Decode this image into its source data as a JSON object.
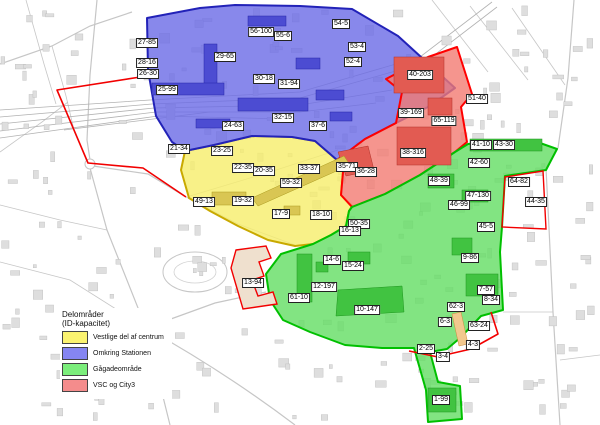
{
  "legend": {
    "title_line1": "Delområder",
    "title_line2": "(ID-kapacitet)",
    "items": [
      {
        "zone": "vestlige",
        "label": "Vestlige del af centrum",
        "color": "#fbf370"
      },
      {
        "zone": "station",
        "label": "Omkring Stationen",
        "color": "#8585f2"
      },
      {
        "zone": "gagade",
        "label": "Gågadeområde",
        "color": "#7bee7b"
      },
      {
        "zone": "vsc",
        "label": "VSC og City3",
        "color": "#f48c8c"
      }
    ]
  },
  "zones": {
    "station": {
      "name": "Omkring Stationen",
      "fill": "#6a6ae6",
      "border": "#2222b8"
    },
    "vestlige": {
      "name": "Vestlige del af centrum",
      "fill": "#f6ee6a",
      "border": "#c9a900"
    },
    "gagade": {
      "name": "Gågadeområde",
      "fill": "#63dd63",
      "border": "#00c000"
    },
    "vsc": {
      "name": "VSC og City3",
      "fill": "#f27b72",
      "border": "#ff0000"
    }
  },
  "map": {
    "labels": [
      {
        "id": "27-85",
        "zone": "station",
        "x": 147,
        "y": 43
      },
      {
        "id": "28-16",
        "zone": "station",
        "x": 147,
        "y": 63
      },
      {
        "id": "26-30",
        "zone": "station",
        "x": 148,
        "y": 74
      },
      {
        "id": "25-99",
        "zone": "station",
        "x": 167,
        "y": 90
      },
      {
        "id": "56-100",
        "zone": "station",
        "x": 261,
        "y": 32
      },
      {
        "id": "55-6",
        "zone": "station",
        "x": 283,
        "y": 36
      },
      {
        "id": "29-65",
        "zone": "station",
        "x": 225,
        "y": 57
      },
      {
        "id": "54-5",
        "zone": "station",
        "x": 341,
        "y": 24
      },
      {
        "id": "53-4",
        "zone": "station",
        "x": 357,
        "y": 47
      },
      {
        "id": "52-4",
        "zone": "station",
        "x": 353,
        "y": 62
      },
      {
        "id": "30-18",
        "zone": "station",
        "x": 264,
        "y": 79
      },
      {
        "id": "31-94",
        "zone": "station",
        "x": 289,
        "y": 84
      },
      {
        "id": "32-15",
        "zone": "station",
        "x": 283,
        "y": 118
      },
      {
        "id": "37-6",
        "zone": "station",
        "x": 318,
        "y": 126
      },
      {
        "id": "24-63",
        "zone": "station",
        "x": 233,
        "y": 126
      },
      {
        "id": "21-34",
        "zone": "station",
        "x": 179,
        "y": 149
      },
      {
        "id": "23-25",
        "zone": "vestlige",
        "x": 222,
        "y": 151
      },
      {
        "id": "22-35",
        "zone": "vestlige",
        "x": 243,
        "y": 168
      },
      {
        "id": "20-35",
        "zone": "vestlige",
        "x": 264,
        "y": 171
      },
      {
        "id": "33-37",
        "zone": "vestlige",
        "x": 309,
        "y": 169
      },
      {
        "id": "59-32",
        "zone": "vestlige",
        "x": 291,
        "y": 183
      },
      {
        "id": "49-13",
        "zone": "vestlige",
        "x": 204,
        "y": 202
      },
      {
        "id": "19-32",
        "zone": "vestlige",
        "x": 243,
        "y": 201
      },
      {
        "id": "17-9",
        "zone": "vestlige",
        "x": 281,
        "y": 214
      },
      {
        "id": "18-10",
        "zone": "vestlige",
        "x": 321,
        "y": 215
      },
      {
        "id": "40-203",
        "zone": "vsc",
        "x": 420,
        "y": 75
      },
      {
        "id": "51-40",
        "zone": "vsc",
        "x": 477,
        "y": 99
      },
      {
        "id": "39-169",
        "zone": "vsc",
        "x": 411,
        "y": 113
      },
      {
        "id": "65-119",
        "zone": "vsc",
        "x": 444,
        "y": 121
      },
      {
        "id": "38-316",
        "zone": "vsc",
        "x": 413,
        "y": 153
      },
      {
        "id": "35-71",
        "zone": "vsc",
        "x": 347,
        "y": 167
      },
      {
        "id": "36-28",
        "zone": "vsc",
        "x": 366,
        "y": 172
      },
      {
        "id": "13-94",
        "zone": "vsc",
        "x": 253,
        "y": 283
      },
      {
        "id": "44-35",
        "zone": "vsc",
        "x": 536,
        "y": 202
      },
      {
        "id": "41-10",
        "zone": "gagade",
        "x": 481,
        "y": 145
      },
      {
        "id": "43-30",
        "zone": "gagade",
        "x": 504,
        "y": 145
      },
      {
        "id": "42-60",
        "zone": "gagade",
        "x": 479,
        "y": 163
      },
      {
        "id": "48-39",
        "zone": "gagade",
        "x": 439,
        "y": 181
      },
      {
        "id": "47-130",
        "zone": "gagade",
        "x": 478,
        "y": 196
      },
      {
        "id": "46-99",
        "zone": "gagade",
        "x": 459,
        "y": 205
      },
      {
        "id": "64-82",
        "zone": "gagade",
        "x": 519,
        "y": 182
      },
      {
        "id": "45-5",
        "zone": "gagade",
        "x": 486,
        "y": 227
      },
      {
        "id": "50-35",
        "zone": "gagade",
        "x": 359,
        "y": 224
      },
      {
        "id": "16-13",
        "zone": "gagade",
        "x": 350,
        "y": 231
      },
      {
        "id": "14-6",
        "zone": "gagade",
        "x": 332,
        "y": 260
      },
      {
        "id": "15-24",
        "zone": "gagade",
        "x": 353,
        "y": 266
      },
      {
        "id": "12-197",
        "zone": "gagade",
        "x": 324,
        "y": 287
      },
      {
        "id": "61-10",
        "zone": "gagade",
        "x": 299,
        "y": 298
      },
      {
        "id": "10-147",
        "zone": "gagade",
        "x": 367,
        "y": 310
      },
      {
        "id": "9-86",
        "zone": "gagade",
        "x": 470,
        "y": 258
      },
      {
        "id": "7-57",
        "zone": "gagade",
        "x": 486,
        "y": 290
      },
      {
        "id": "8-34",
        "zone": "gagade",
        "x": 491,
        "y": 300
      },
      {
        "id": "62-3",
        "zone": "gagade",
        "x": 456,
        "y": 307
      },
      {
        "id": "6-3",
        "zone": "gagade",
        "x": 445,
        "y": 322
      },
      {
        "id": "63-24",
        "zone": "gagade",
        "x": 479,
        "y": 326
      },
      {
        "id": "2-25",
        "zone": "gagade",
        "x": 426,
        "y": 349
      },
      {
        "id": "4-3",
        "zone": "gagade",
        "x": 473,
        "y": 345
      },
      {
        "id": "3-4",
        "zone": "gagade",
        "x": 443,
        "y": 357
      },
      {
        "id": "1-99",
        "zone": "gagade",
        "x": 441,
        "y": 400
      }
    ]
  }
}
